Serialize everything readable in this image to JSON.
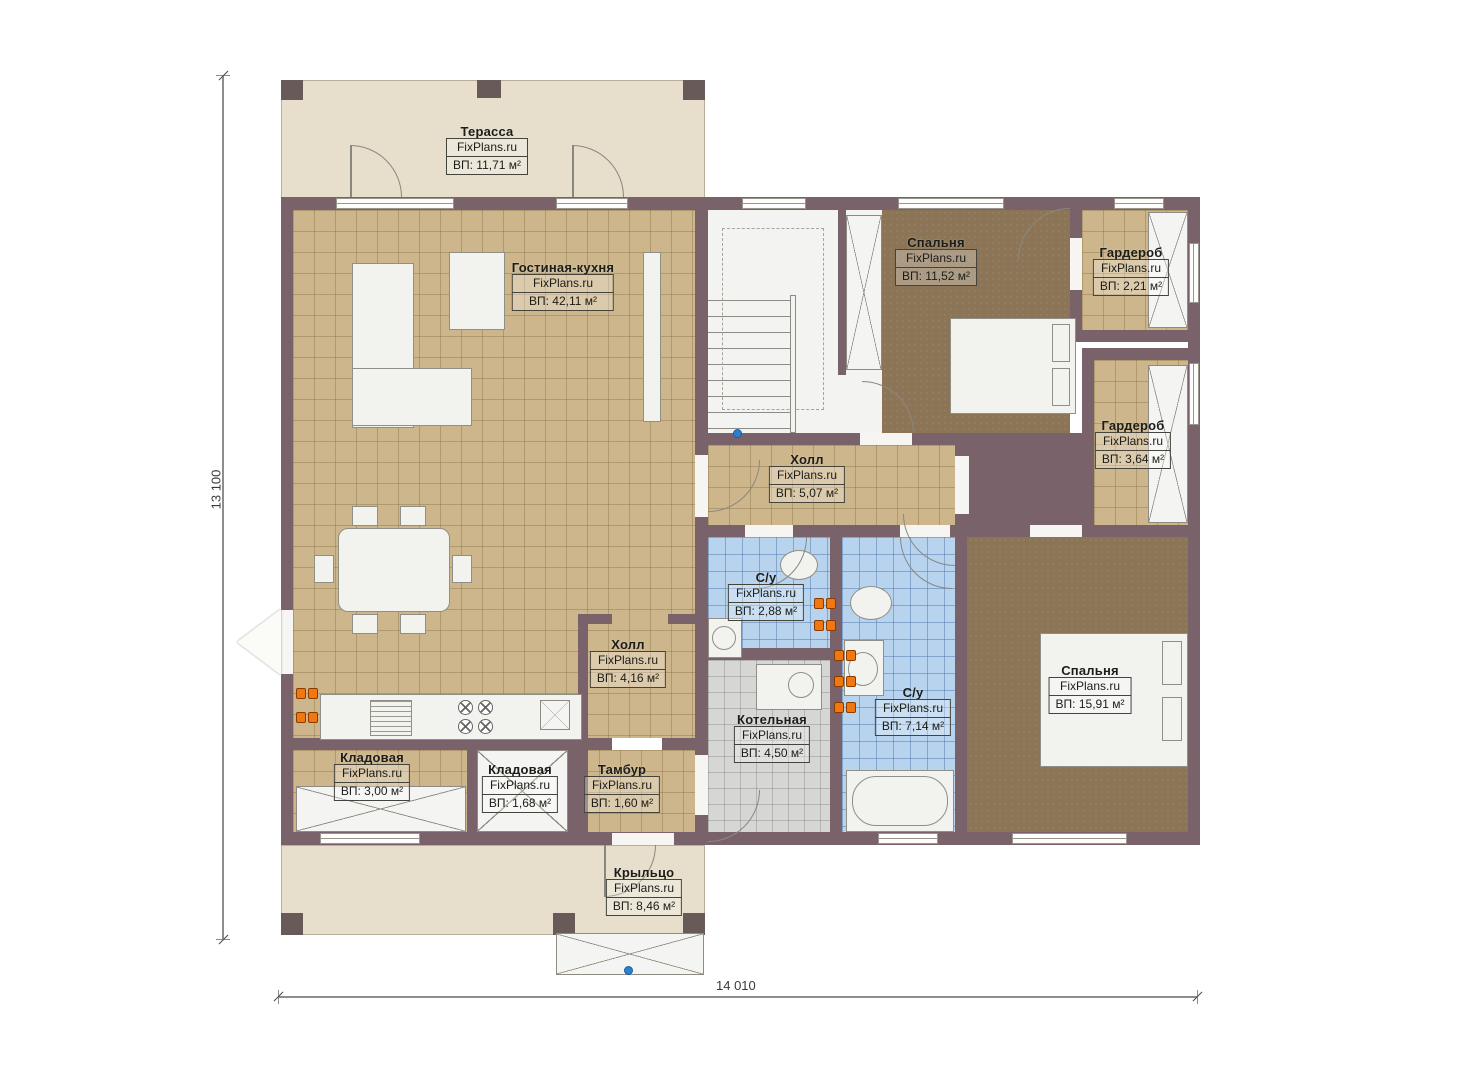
{
  "plan": {
    "brand": "FixPlans.ru",
    "dimensions": {
      "vertical": "13 100",
      "horizontal": "14 010"
    },
    "rooms": [
      {
        "name": "Терасса",
        "area": "ВП: 11,71 м²"
      },
      {
        "name": "Гостиная-кухня",
        "area": "ВП: 42,11 м²"
      },
      {
        "name": "Спальня",
        "area": "ВП: 11,52 м²"
      },
      {
        "name": "Гардероб",
        "area": "ВП: 2,21 м²"
      },
      {
        "name": "Гардероб",
        "area": "ВП: 3,64 м²"
      },
      {
        "name": "Холл",
        "area": "ВП: 5,07 м²"
      },
      {
        "name": "С/у",
        "area": "ВП: 2,88 м²"
      },
      {
        "name": "Холл",
        "area": "ВП: 4,16 м²"
      },
      {
        "name": "С/у",
        "area": "ВП: 7,14 м²"
      },
      {
        "name": "Спальня",
        "area": "ВП: 15,91 м²"
      },
      {
        "name": "Котельная",
        "area": "ВП: 4,50 м²"
      },
      {
        "name": "Кладовая",
        "area": "ВП: 3,00 м²"
      },
      {
        "name": "Кладовая",
        "area": "ВП: 1,68 м²"
      },
      {
        "name": "Тамбур",
        "area": "ВП: 1,60 м²"
      },
      {
        "name": "Крыльцо",
        "area": "ВП: 8,46 м²"
      }
    ],
    "colors": {
      "wall": "#7a626b",
      "terrace_floor": "#e7decb",
      "tile_floor": "#cdb68c",
      "bedroom_floor": "#8b7556",
      "bath_floor": "#b7d3ee",
      "boiler_floor": "#d6d6d4",
      "radiator": "#f3770f",
      "marker_blue": "#2d7fd0"
    }
  }
}
